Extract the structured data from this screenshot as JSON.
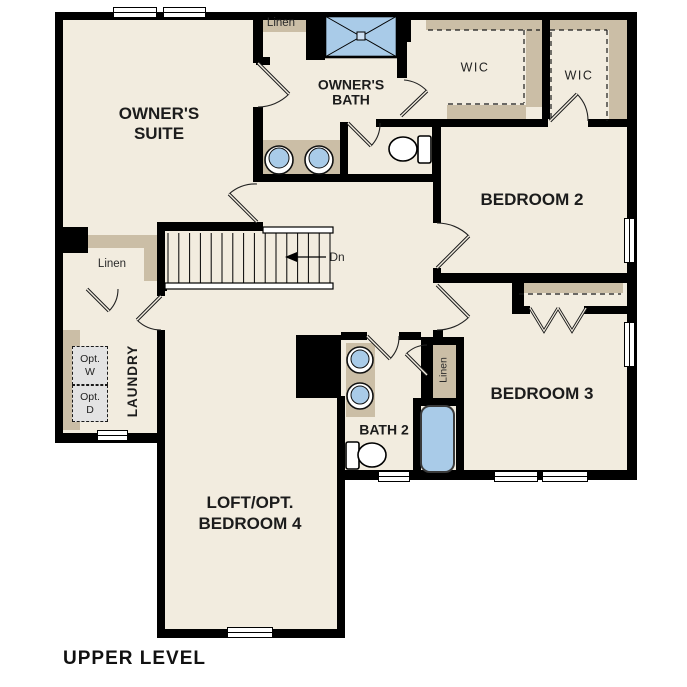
{
  "plan_title": "UPPER LEVEL",
  "rooms": {
    "owners_suite": {
      "line1": "OWNER'S",
      "line2": "SUITE"
    },
    "owners_bath": {
      "line1": "OWNER'S",
      "line2": "BATH"
    },
    "wic_1": {
      "label": "WIC"
    },
    "wic_2": {
      "label": "WIC"
    },
    "bedroom_2": {
      "label": "BEDROOM 2"
    },
    "bedroom_3": {
      "label": "BEDROOM 3"
    },
    "bath_2": {
      "label": "BATH 2"
    },
    "laundry": {
      "label": "LAUNDRY"
    },
    "loft": {
      "line1": "LOFT/OPT.",
      "line2": "BEDROOM 4"
    }
  },
  "closets": {
    "linen_hall": "Linen",
    "linen_owners_bath": "Linen",
    "linen_bath2": "Linen"
  },
  "stairs": {
    "direction_label": "Dn"
  },
  "appliances": {
    "washer_line1": "Opt.",
    "washer_line2": "W",
    "dryer_line1": "Opt.",
    "dryer_line2": "D"
  },
  "colors": {
    "floor": "#F2ECDF",
    "wall": "#000000",
    "cabinet_tan": "#CBBEA6",
    "fixture_blue": "#A9CBE8",
    "appliance_gray": "#E3E3E3"
  }
}
